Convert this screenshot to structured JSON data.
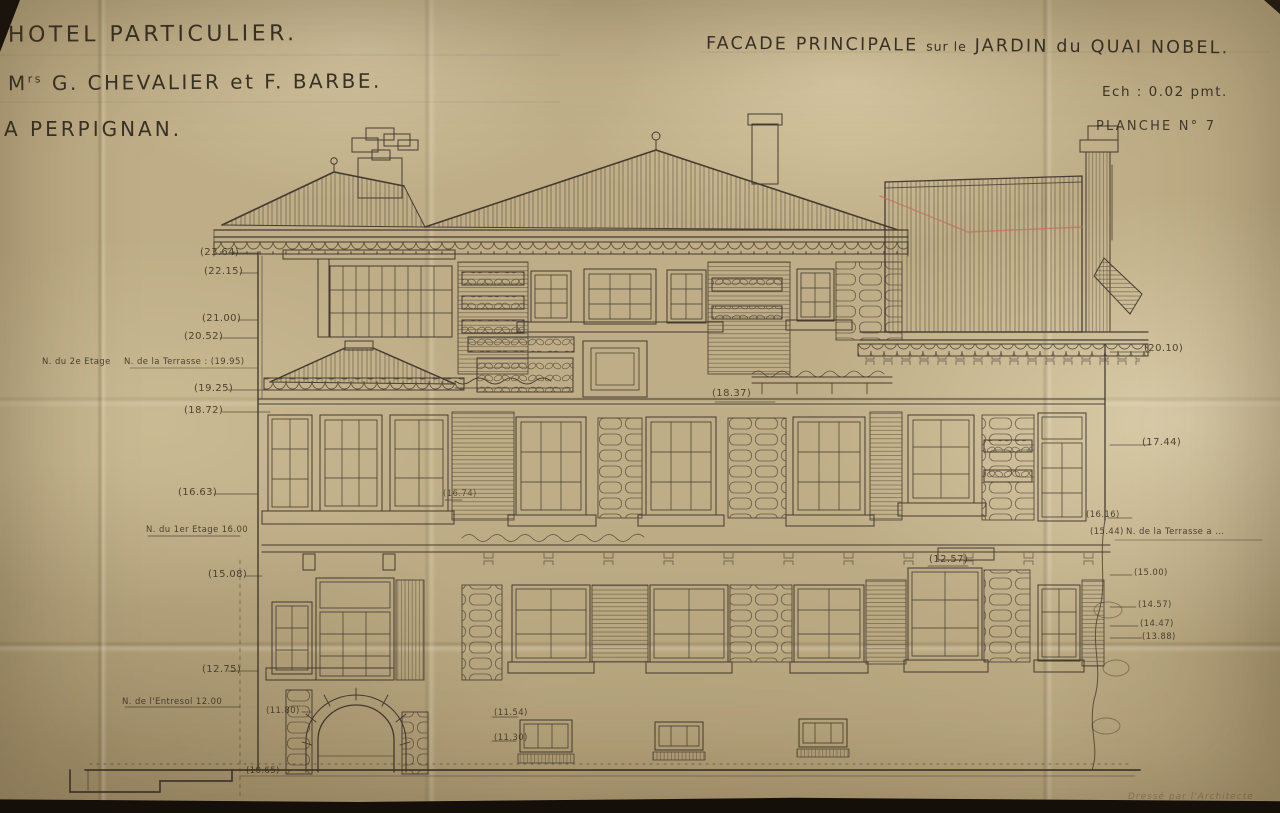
{
  "document": {
    "project_title": "HOTEL PARTICULIER.",
    "client_prefix": "M",
    "client_prefix_sup": "rs",
    "client_names": " G. CHEVALIER et F. BARBE.",
    "location_line": "A PERPIGNAN.",
    "facade_title_caps1": "FACADE PRINCIPALE",
    "facade_title_small": "sur le",
    "facade_title_caps2": "JARDIN du QUAI NOBEL.",
    "scale_label": "Ech : 0.02 pmt.",
    "sheet_label": "PLANCHE N°",
    "sheet_number": "7",
    "signature_note": "Dressé par l'Architecte"
  },
  "levels": {
    "left": [
      {
        "label": "(23.64)"
      },
      {
        "label": "(22.15)"
      },
      {
        "label": "(21.00)"
      },
      {
        "label": "(20.52)"
      },
      {
        "label": "N. du 2e Etage"
      },
      {
        "label": "N. de la Terrasse : (19.95)"
      },
      {
        "label": "(19.25)"
      },
      {
        "label": "(18.72)"
      },
      {
        "label": "(16.63)"
      },
      {
        "label": "N. du 1er Etage 16.00"
      },
      {
        "label": "(15.08)"
      },
      {
        "label": "(12.75)"
      },
      {
        "label": "N. de l'Entresol 12.00"
      },
      {
        "label": "(11.80)"
      },
      {
        "label": "(10.65)"
      }
    ],
    "center": [
      {
        "label": "(18.37)"
      },
      {
        "label": "(16.74)"
      },
      {
        "label": "(12.57)"
      },
      {
        "label": "(11.54)"
      },
      {
        "label": "(11.30)"
      }
    ],
    "right": [
      {
        "label": "(20.10)"
      },
      {
        "label": "(17.44)"
      },
      {
        "label": "(16.16)"
      },
      {
        "label": "(15.44)"
      },
      {
        "label": "N. de la Terrasse a ..."
      },
      {
        "label": "(15.00)"
      },
      {
        "label": "(14.57)"
      },
      {
        "label": "(14.47)"
      },
      {
        "label": "(13.88)"
      }
    ]
  },
  "colors": {
    "paper": "#bead86",
    "ink": "#3b3228",
    "red_pencil": "#c2685f"
  }
}
